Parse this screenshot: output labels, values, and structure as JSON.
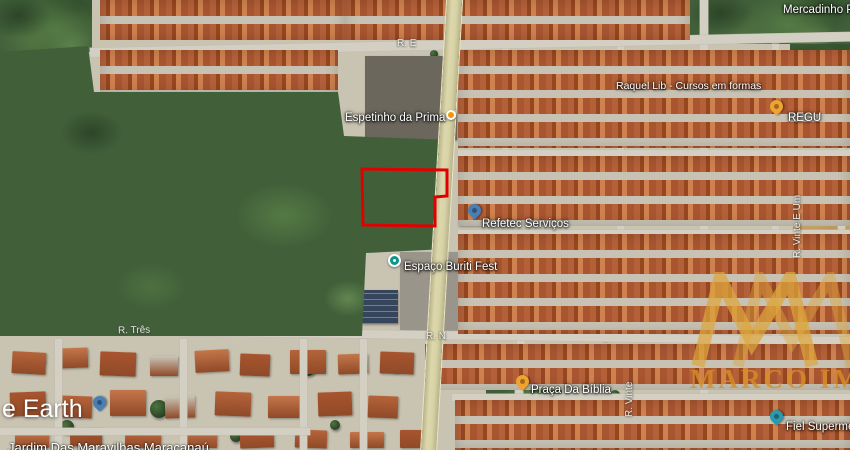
{
  "app": {
    "name": "Google Earth",
    "logo_fragment": "e Earth"
  },
  "caption": {
    "area_label": "Jardim Das Maravilhas Maracanaú"
  },
  "watermark": {
    "brand": "MARCO IMAG",
    "color": "#D98E25"
  },
  "plot": {
    "outline_color": "#E10000",
    "shape": "polygon"
  },
  "colors": {
    "pin_blue": "#4A7FB5",
    "pin_yellow": "#F0A32E",
    "poi_dot_orange": "#F29900",
    "venue_teal": "#0E9488",
    "road_yellow": "#D8D3A6",
    "roof_orange": "#B4613A",
    "vegetation_green": "#41603A"
  },
  "pois": [
    {
      "id": "espetinho",
      "label": "Espetinho da Prima",
      "marker": "orange-dot"
    },
    {
      "id": "refetec",
      "label": "Refetec Serviços",
      "marker": "blue-pin"
    },
    {
      "id": "buriti",
      "label": "Espaço Buriti Fest",
      "marker": "teal-circle"
    },
    {
      "id": "praca",
      "label": "Praça Da Bíblia",
      "marker": "yellow-pin"
    },
    {
      "id": "fiel",
      "label": "Fiel Supermerc",
      "marker": "teal-pin"
    },
    {
      "id": "mercadinho",
      "label": "Mercadinho Pie",
      "marker": "none"
    },
    {
      "id": "raquel",
      "label": "Raquel Lib - Cursos em formas",
      "marker": "none"
    },
    {
      "id": "regu",
      "label": "REGU",
      "marker": "yellow-pin"
    },
    {
      "id": "unnamed",
      "label": "",
      "marker": "blue-pin"
    }
  ],
  "streets": [
    {
      "id": "r-tres",
      "label": "R. Três",
      "orientation": "horizontal"
    },
    {
      "id": "r-n",
      "label": "R. N",
      "orientation": "horizontal"
    },
    {
      "id": "r-e",
      "label": "R. E",
      "orientation": "horizontal"
    },
    {
      "id": "r-vinte-e-um",
      "label": "R. Vinte E Um",
      "orientation": "vertical"
    },
    {
      "id": "r-vinte",
      "label": "R. Vinte",
      "orientation": "vertical"
    }
  ]
}
